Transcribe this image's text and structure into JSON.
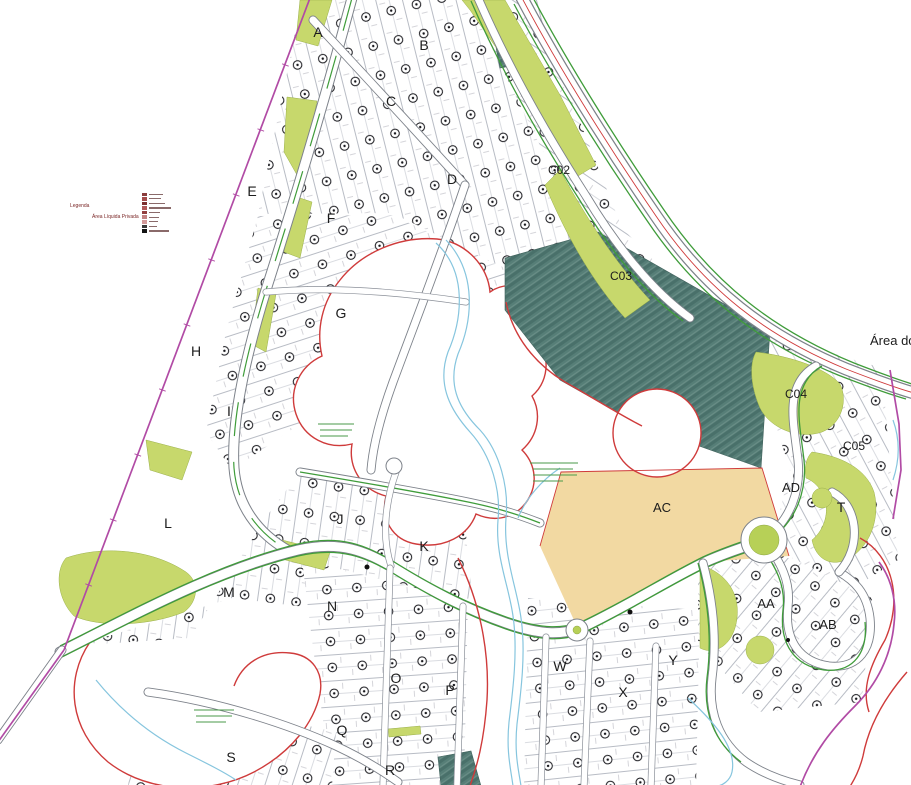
{
  "map": {
    "area_text": "Área do",
    "legend": {
      "title": "Legenda",
      "area_label": "Área Líquida Privada",
      "items": [
        {
          "color": "#8a3c3c",
          "w": 14
        },
        {
          "color": "#a34b4b",
          "w": 12
        },
        {
          "color": "#7c2f2f",
          "w": 16
        },
        {
          "color": "#b05858",
          "w": 22
        },
        {
          "color": "#933f3f",
          "w": 11
        },
        {
          "color": "#c28181",
          "w": 10
        },
        {
          "color": "#d39a9a",
          "w": 9
        },
        {
          "color": "#3a3a3a",
          "w": 8
        },
        {
          "color": "#141414",
          "w": 20
        }
      ]
    },
    "block_labels": [
      {
        "label": "A",
        "x": 318,
        "y": 37,
        "s": 14
      },
      {
        "label": "B",
        "x": 424,
        "y": 50,
        "s": 14
      },
      {
        "label": "C",
        "x": 391,
        "y": 106,
        "s": 14
      },
      {
        "label": "D",
        "x": 452,
        "y": 184,
        "s": 14
      },
      {
        "label": "E",
        "x": 252,
        "y": 196,
        "s": 14
      },
      {
        "label": "F",
        "x": 331,
        "y": 223,
        "s": 14
      },
      {
        "label": "G",
        "x": 341,
        "y": 318,
        "s": 14
      },
      {
        "label": "H",
        "x": 196,
        "y": 356,
        "s": 14
      },
      {
        "label": "I",
        "x": 229,
        "y": 416,
        "s": 14
      },
      {
        "label": "J",
        "x": 340,
        "y": 524,
        "s": 14
      },
      {
        "label": "K",
        "x": 424,
        "y": 551,
        "s": 14
      },
      {
        "label": "L",
        "x": 168,
        "y": 528,
        "s": 14
      },
      {
        "label": "M",
        "x": 229,
        "y": 597,
        "s": 14
      },
      {
        "label": "N",
        "x": 332,
        "y": 611,
        "s": 14
      },
      {
        "label": "O",
        "x": 396,
        "y": 683,
        "s": 14
      },
      {
        "label": "P",
        "x": 450,
        "y": 695,
        "s": 14
      },
      {
        "label": "Q",
        "x": 342,
        "y": 735,
        "s": 14
      },
      {
        "label": "R",
        "x": 390,
        "y": 775,
        "s": 14
      },
      {
        "label": "S",
        "x": 231,
        "y": 762,
        "s": 14
      },
      {
        "label": "T",
        "x": 841,
        "y": 512,
        "s": 14
      },
      {
        "label": "W",
        "x": 560,
        "y": 671,
        "s": 14
      },
      {
        "label": "X",
        "x": 623,
        "y": 697,
        "s": 14
      },
      {
        "label": "Y",
        "x": 673,
        "y": 665,
        "s": 14
      },
      {
        "label": "AA",
        "x": 766,
        "y": 608,
        "s": 13
      },
      {
        "label": "AB",
        "x": 828,
        "y": 629,
        "s": 13
      },
      {
        "label": "AC",
        "x": 662,
        "y": 512,
        "s": 13
      },
      {
        "label": "AD",
        "x": 791,
        "y": 492,
        "s": 13
      },
      {
        "label": "C02",
        "x": 559,
        "y": 174,
        "s": 12
      },
      {
        "label": "C03",
        "x": 621,
        "y": 280,
        "s": 12
      },
      {
        "label": "C04",
        "x": 796,
        "y": 398,
        "s": 12
      },
      {
        "label": "C05",
        "x": 854,
        "y": 450,
        "s": 12
      }
    ],
    "colors": {
      "boundary": "#b14ba5",
      "preservation": "#cf3b3b",
      "road_edge_green": "#3f9c3a",
      "green_area": "#c7d86c",
      "green_area_dark": "#b7d057",
      "teal_area": "#567e77",
      "beige_area": "#f2d9a2",
      "stream": "#86c5de",
      "label": "#1c1c1c"
    }
  }
}
